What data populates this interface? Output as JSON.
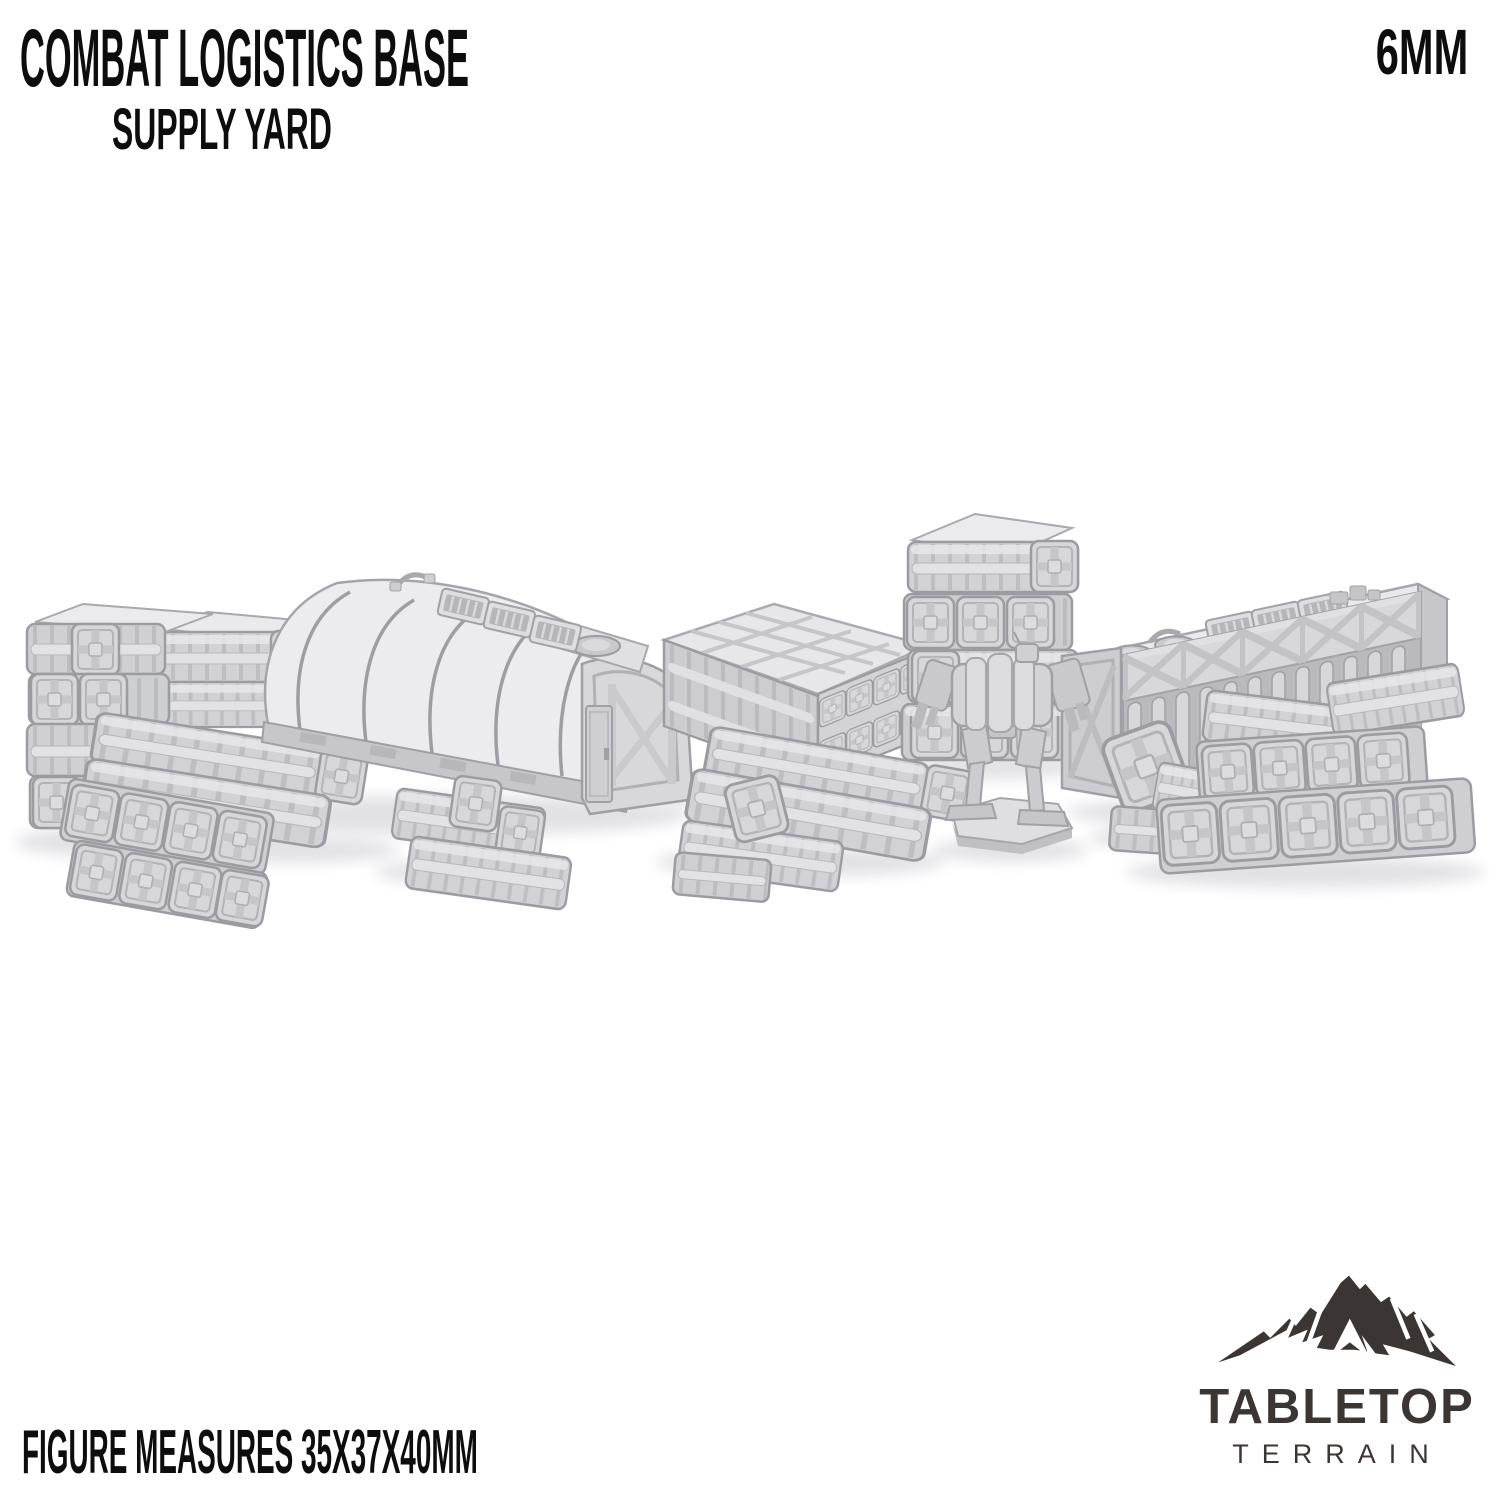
{
  "header": {
    "title": "COMBAT LOGISTICS BASE",
    "subtitle": "SUPPLY YARD",
    "scale_label": "6MM"
  },
  "footer": {
    "figure_note": "FIGURE MEASURES 35X37X40MM"
  },
  "brand": {
    "logo_icon": "mountain-icon",
    "wordmark_top": "TABLETOP",
    "wordmark_bottom": "TERRAIN",
    "logo_color": "#3b3633"
  },
  "scene": {
    "items": [
      "crate-stack-left",
      "quonset-supply-hut",
      "small-crate-stack",
      "crate-pallet",
      "crate-rows-middle",
      "crate-tower",
      "battlemech-figure",
      "storage-warehouse",
      "crate-stack-right"
    ]
  },
  "palette": {
    "background": "#ffffff",
    "text": "#0d0d0d",
    "logo": "#3b3633",
    "model_highlight": "#ececee",
    "model_light": "#e2e2e5",
    "model_mid": "#d2d2d6",
    "model_shadow": "#c3c3c8",
    "model_line": "#9b9ba1",
    "ground_shadow": "#dddde1"
  }
}
